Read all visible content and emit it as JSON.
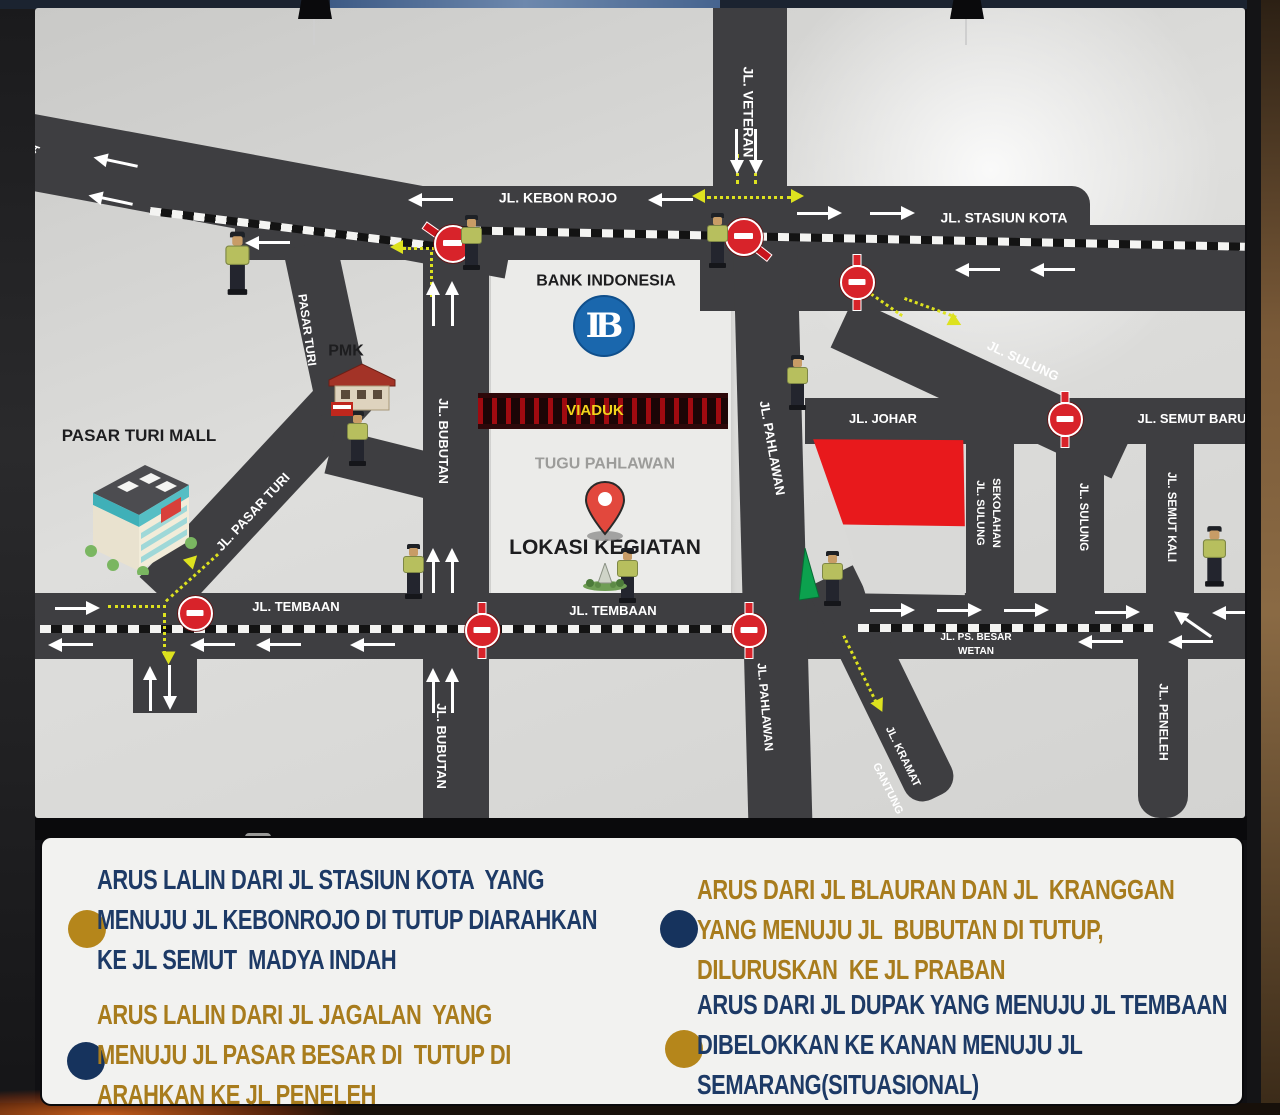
{
  "colors": {
    "road": "#3e3e41",
    "yellow": "#dde21f",
    "sign_red": "#d8232a",
    "navy_text": "#1d3a66",
    "gold_text": "#a87c1d",
    "bullet_gold": "#b5861b",
    "bullet_navy": "#16335d",
    "label_white": "#ffffff",
    "label_black": "#1d1d1f",
    "label_gray": "#9c9c9a",
    "label_yellow": "#f2d41c",
    "kantor_red": "#e8191c"
  },
  "map": {
    "bank_logo_text": "IB",
    "roads": [
      {
        "n": "jl-semarang-approach",
        "x": -15,
        "y": 104,
        "w": 500,
        "h": 76,
        "r": 10.5
      },
      {
        "n": "jl-kebon-rojo",
        "x": 200,
        "y": 178,
        "w": 855,
        "h": 74,
        "br": "0 18px 18px 0"
      },
      {
        "n": "jl-stasiun-kota-band",
        "x": 665,
        "y": 217,
        "w": 545,
        "h": 86
      },
      {
        "n": "jl-veteran",
        "x": 678,
        "y": -8,
        "w": 74,
        "h": 198
      },
      {
        "n": "jl-sulung-diagonal",
        "x": 807,
        "y": 288,
        "w": 310,
        "h": 54,
        "r": 25
      },
      {
        "n": "jl-johar-semut-baru",
        "x": 770,
        "y": 390,
        "w": 440,
        "h": 46
      },
      {
        "n": "jl-sulung-sekolahan",
        "x": 931,
        "y": 424,
        "w": 48,
        "h": 176
      },
      {
        "n": "jl-sulung-vertical",
        "x": 1021,
        "y": 424,
        "w": 48,
        "h": 176
      },
      {
        "n": "jl-semut-kali",
        "x": 1111,
        "y": 424,
        "w": 48,
        "h": 176
      },
      {
        "n": "jl-peneleh",
        "x": 1103,
        "y": 642,
        "w": 50,
        "h": 168,
        "br": "0 0 22px 22px"
      },
      {
        "n": "jl-tembaan-ps-besar",
        "x": 0,
        "y": 585,
        "w": 1210,
        "h": 66
      },
      {
        "n": "jl-bubutan",
        "x": 388,
        "y": 232,
        "w": 66,
        "h": 580
      },
      {
        "n": "jl-pahlawan",
        "x": 698,
        "y": 227,
        "w": 64,
        "h": 585,
        "r": -1.5,
        "o": "50% 0"
      },
      {
        "n": "jl-kramat-gantung",
        "x": 771,
        "y": 580,
        "w": 52,
        "h": 245,
        "r": -26,
        "o": "0 0",
        "br": "0 0 20px 20px"
      },
      {
        "n": "jl-pasar-turi-diagonal",
        "x": 125,
        "y": 560,
        "w": 300,
        "h": 56,
        "r": -47
      },
      {
        "n": "pasar-turi-upper",
        "x": 248,
        "y": 242,
        "w": 54,
        "h": 170,
        "r": -12,
        "o": "0 0"
      },
      {
        "n": "pmk-connector",
        "x": 295,
        "y": 420,
        "w": 105,
        "h": 46,
        "r": 14
      },
      {
        "n": "jl-semarang-stub",
        "x": 98,
        "y": 617,
        "w": 64,
        "h": 88
      }
    ],
    "dashes": [
      {
        "x": 115,
        "y": 199,
        "w": 305,
        "r": 7
      },
      {
        "x": 413,
        "y": 218,
        "w": 797,
        "r": 1.2
      },
      {
        "x": 5,
        "y": 617,
        "w": 712,
        "r": 0
      },
      {
        "x": 823,
        "y": 616,
        "w": 295,
        "r": 0
      }
    ],
    "labels": [
      {
        "t": "JL. VETERAN",
        "x": 713,
        "y": 104,
        "r": 90,
        "fs": 14,
        "c": "w"
      },
      {
        "t": "JL. KEBON ROJO",
        "x": 523,
        "y": 190,
        "fs": 14,
        "c": "w"
      },
      {
        "t": "JL. STASIUN KOTA",
        "x": 969,
        "y": 210,
        "fs": 14,
        "c": "w"
      },
      {
        "t": "JL. SULUNG",
        "x": 988,
        "y": 353,
        "r": 25,
        "fs": 13,
        "c": "w"
      },
      {
        "t": "JL. JOHAR",
        "x": 848,
        "y": 411,
        "fs": 13,
        "c": "w"
      },
      {
        "t": "JL. SEMUT BARU",
        "x": 1157,
        "y": 411,
        "fs": 13,
        "c": "w"
      },
      {
        "t": "JL. SULUNG",
        "x": 944,
        "y": 505,
        "r": 90,
        "fs": 11,
        "c": "w"
      },
      {
        "t": "SEKOLAHAN",
        "x": 960,
        "y": 505,
        "r": 90,
        "fs": 11,
        "c": "w"
      },
      {
        "t": "JL. SULUNG",
        "x": 1048,
        "y": 509,
        "r": 90,
        "fs": 11.5,
        "c": "w"
      },
      {
        "t": "JL. SEMUT KALI",
        "x": 1136,
        "y": 509,
        "r": 90,
        "fs": 11.5,
        "c": "w"
      },
      {
        "t": "JL. PENELEH",
        "x": 1128,
        "y": 714,
        "r": 90,
        "fs": 12,
        "c": "w"
      },
      {
        "t": "JL. PAHLAWAN",
        "x": 737,
        "y": 440,
        "r": 80,
        "fs": 13,
        "c": "w"
      },
      {
        "t": "JL. PAHLAWAN",
        "x": 730,
        "y": 699,
        "r": 85,
        "fs": 12,
        "c": "w"
      },
      {
        "t": "JL. BUBUTAN",
        "x": 408,
        "y": 433,
        "r": 90,
        "fs": 13,
        "c": "w"
      },
      {
        "t": "JL. BUBUTAN",
        "x": 406,
        "y": 738,
        "r": 90,
        "fs": 13,
        "c": "w"
      },
      {
        "t": "JL. KRAMAT",
        "x": 867,
        "y": 749,
        "r": 64,
        "fs": 11,
        "c": "w"
      },
      {
        "t": "GANTUNG",
        "x": 852,
        "y": 781,
        "r": 64,
        "fs": 11,
        "c": "w"
      },
      {
        "t": "PASAR TURI",
        "x": 272,
        "y": 322,
        "r": 82,
        "fs": 12,
        "c": "w"
      },
      {
        "t": "JL. PASAR TURI",
        "x": 218,
        "y": 504,
        "r": -47,
        "fs": 13,
        "c": "w"
      },
      {
        "t": "JL. TEMBAAN",
        "x": 261,
        "y": 599,
        "fs": 13,
        "c": "w"
      },
      {
        "t": "JL. TEMBAAN",
        "x": 578,
        "y": 603,
        "fs": 13,
        "c": "w"
      },
      {
        "t": "JL. PS. BESAR",
        "x": 941,
        "y": 630,
        "fs": 10,
        "c": "w"
      },
      {
        "t": "WETAN",
        "x": 941,
        "y": 644,
        "fs": 10,
        "c": "w"
      },
      {
        "t": "A",
        "x": 0,
        "y": 140,
        "r": -50,
        "fs": 12,
        "c": "w"
      },
      {
        "t": "BANK INDONESIA",
        "x": 571,
        "y": 274,
        "fs": 16,
        "c": "k"
      },
      {
        "t": "PMK",
        "x": 311,
        "y": 344,
        "fs": 16,
        "c": "k"
      },
      {
        "t": "PASAR TURI MALL",
        "x": 104,
        "y": 428,
        "fs": 17,
        "c": "k"
      },
      {
        "t": "TUGU PAHLAWAN",
        "x": 570,
        "y": 457,
        "fs": 16,
        "c": "g"
      },
      {
        "t": "LOKASI KEGIATAN",
        "x": 570,
        "y": 540,
        "fs": 21,
        "c": "k"
      },
      {
        "t": "VIADUK",
        "x": 560,
        "y": 403,
        "fs": 15,
        "c": "y"
      },
      {
        "t": "KANTOR",
        "x": 858,
        "y": 452,
        "fs": 16,
        "c": "w"
      },
      {
        "t": "GUBERNUR",
        "x": 858,
        "y": 475,
        "fs": 16,
        "c": "w"
      },
      {
        "t": "JATIM",
        "x": 858,
        "y": 498,
        "fs": 16,
        "c": "w"
      }
    ],
    "no_entry": [
      {
        "x": 158,
        "y": 603
      },
      {
        "x": 445,
        "y": 620,
        "p": 1
      },
      {
        "x": 712,
        "y": 620,
        "p": 1
      },
      {
        "x": 820,
        "y": 272,
        "p": 1
      },
      {
        "x": 1028,
        "y": 409,
        "p": 1
      }
    ],
    "paddles": [
      {
        "x": 417,
        "y": 235,
        "a": 215
      },
      {
        "x": 708,
        "y": 228,
        "a": 38
      }
    ],
    "arrows": [
      {
        "x": 80,
        "y": 154,
        "r": 192
      },
      {
        "x": 75,
        "y": 192,
        "r": 192
      },
      {
        "x": 232,
        "y": 235,
        "r": 180
      },
      {
        "x": 395,
        "y": 192,
        "r": 180
      },
      {
        "x": 635,
        "y": 192,
        "r": 180
      },
      {
        "x": 785,
        "y": 205,
        "r": 0
      },
      {
        "x": 858,
        "y": 205,
        "r": 0
      },
      {
        "x": 942,
        "y": 262,
        "r": 180
      },
      {
        "x": 1017,
        "y": 262,
        "r": 180
      },
      {
        "x": 702,
        "y": 144,
        "r": 90
      },
      {
        "x": 721,
        "y": 144,
        "r": 90
      },
      {
        "x": 398,
        "y": 295,
        "r": 270
      },
      {
        "x": 417,
        "y": 295,
        "r": 270
      },
      {
        "x": 398,
        "y": 562,
        "r": 270
      },
      {
        "x": 417,
        "y": 562,
        "r": 270
      },
      {
        "x": 398,
        "y": 682,
        "r": 270
      },
      {
        "x": 417,
        "y": 682,
        "r": 270
      },
      {
        "x": 43,
        "y": 600,
        "r": 0
      },
      {
        "x": 35,
        "y": 637,
        "r": 180
      },
      {
        "x": 177,
        "y": 637,
        "r": 180
      },
      {
        "x": 243,
        "y": 637,
        "r": 180
      },
      {
        "x": 337,
        "y": 637,
        "r": 180
      },
      {
        "x": 858,
        "y": 602,
        "r": 0
      },
      {
        "x": 925,
        "y": 602,
        "r": 0
      },
      {
        "x": 992,
        "y": 602,
        "r": 0
      },
      {
        "x": 1083,
        "y": 604,
        "r": 0
      },
      {
        "x": 1065,
        "y": 634,
        "r": 180
      },
      {
        "x": 1155,
        "y": 634,
        "r": 180
      },
      {
        "x": 1199,
        "y": 605,
        "r": 180
      },
      {
        "x": 1157,
        "y": 616,
        "r": 215
      },
      {
        "x": 115,
        "y": 680,
        "r": 270
      },
      {
        "x": 135,
        "y": 680,
        "r": 90
      }
    ],
    "ydots": [
      {
        "x": 672,
        "y": 188,
        "w": 84,
        "r": 0
      },
      {
        "x": 704,
        "y": 146,
        "w": 30,
        "r": 90
      },
      {
        "x": 722,
        "y": 146,
        "w": 30,
        "r": 90
      },
      {
        "x": 368,
        "y": 239,
        "w": 32,
        "r": 0
      },
      {
        "x": 398,
        "y": 244,
        "w": 45,
        "r": 90
      },
      {
        "x": 823,
        "y": 275,
        "w": 55,
        "r": 35
      },
      {
        "x": 870,
        "y": 289,
        "w": 55,
        "r": 20
      },
      {
        "x": 73,
        "y": 597,
        "w": 58,
        "r": 0
      },
      {
        "x": 130,
        "y": 592,
        "w": 70,
        "r": -42
      },
      {
        "x": 131,
        "y": 605,
        "w": 42,
        "r": 90
      },
      {
        "x": 810,
        "y": 627,
        "w": 80,
        "r": 64
      }
    ],
    "yheads": [
      {
        "x": 663,
        "y": 188,
        "r": 180
      },
      {
        "x": 762,
        "y": 188,
        "r": 0
      },
      {
        "x": 361,
        "y": 239,
        "r": 180
      },
      {
        "x": 920,
        "y": 314,
        "r": 28
      },
      {
        "x": 157,
        "y": 552,
        "r": -45
      },
      {
        "x": 133,
        "y": 650,
        "r": 90
      },
      {
        "x": 844,
        "y": 698,
        "r": 64
      }
    ],
    "police": [
      {
        "x": 203,
        "y": 257,
        "s": 1.15
      },
      {
        "x": 437,
        "y": 236,
        "s": 1
      },
      {
        "x": 683,
        "y": 234,
        "s": 1
      },
      {
        "x": 763,
        "y": 376,
        "s": 1
      },
      {
        "x": 323,
        "y": 432,
        "s": 1
      },
      {
        "x": 379,
        "y": 565,
        "s": 1
      },
      {
        "x": 593,
        "y": 569,
        "s": 1
      },
      {
        "x": 798,
        "y": 572,
        "s": 1
      },
      {
        "x": 1180,
        "y": 550,
        "s": 1.1
      }
    ]
  },
  "legend": {
    "items": [
      {
        "n": "stasiun-kota-closure",
        "bullet": "gold",
        "text": "navy",
        "bx": 26,
        "by": 72,
        "tx": 55,
        "ty": 22,
        "lines": [
          "ARUS LALIN DARI JL STASIUN KOTA  YANG",
          "MENUJU JL KEBONROJO DI TUTUP DIARAHKAN",
          "KE JL SEMUT  MADYA INDAH"
        ]
      },
      {
        "n": "jagalan-closure",
        "bullet": "navy",
        "text": "gold",
        "bx": 25,
        "by": 204,
        "tx": 55,
        "ty": 157,
        "lines": [
          "ARUS LALIN DARI JL JAGALAN  YANG",
          "MENUJU JL PASAR BESAR DI  TUTUP DI",
          "ARAHKAN KE JL PENELEH"
        ]
      },
      {
        "n": "blauran-kranggan-closure",
        "bullet": "navy",
        "text": "gold",
        "bx": 618,
        "by": 72,
        "tx": 655,
        "ty": 32,
        "lines": [
          "ARUS DARI JL BLAURAN DAN JL  KRANGGAN",
          "YANG MENUJU JL  BUBUTAN DI TUTUP,",
          "DILURUSKAN  KE JL PRABAN"
        ]
      },
      {
        "n": "dupak-diversion",
        "bullet": "gold",
        "text": "navy",
        "bx": 623,
        "by": 192,
        "tx": 655,
        "ty": 147,
        "lines": [
          "ARUS DARI JL DUPAK YANG MENUJU JL TEMBAAN",
          "DIBELOKKAN KE KANAN MENUJU JL",
          "SEMARANG(SITUASIONAL)"
        ]
      }
    ]
  }
}
